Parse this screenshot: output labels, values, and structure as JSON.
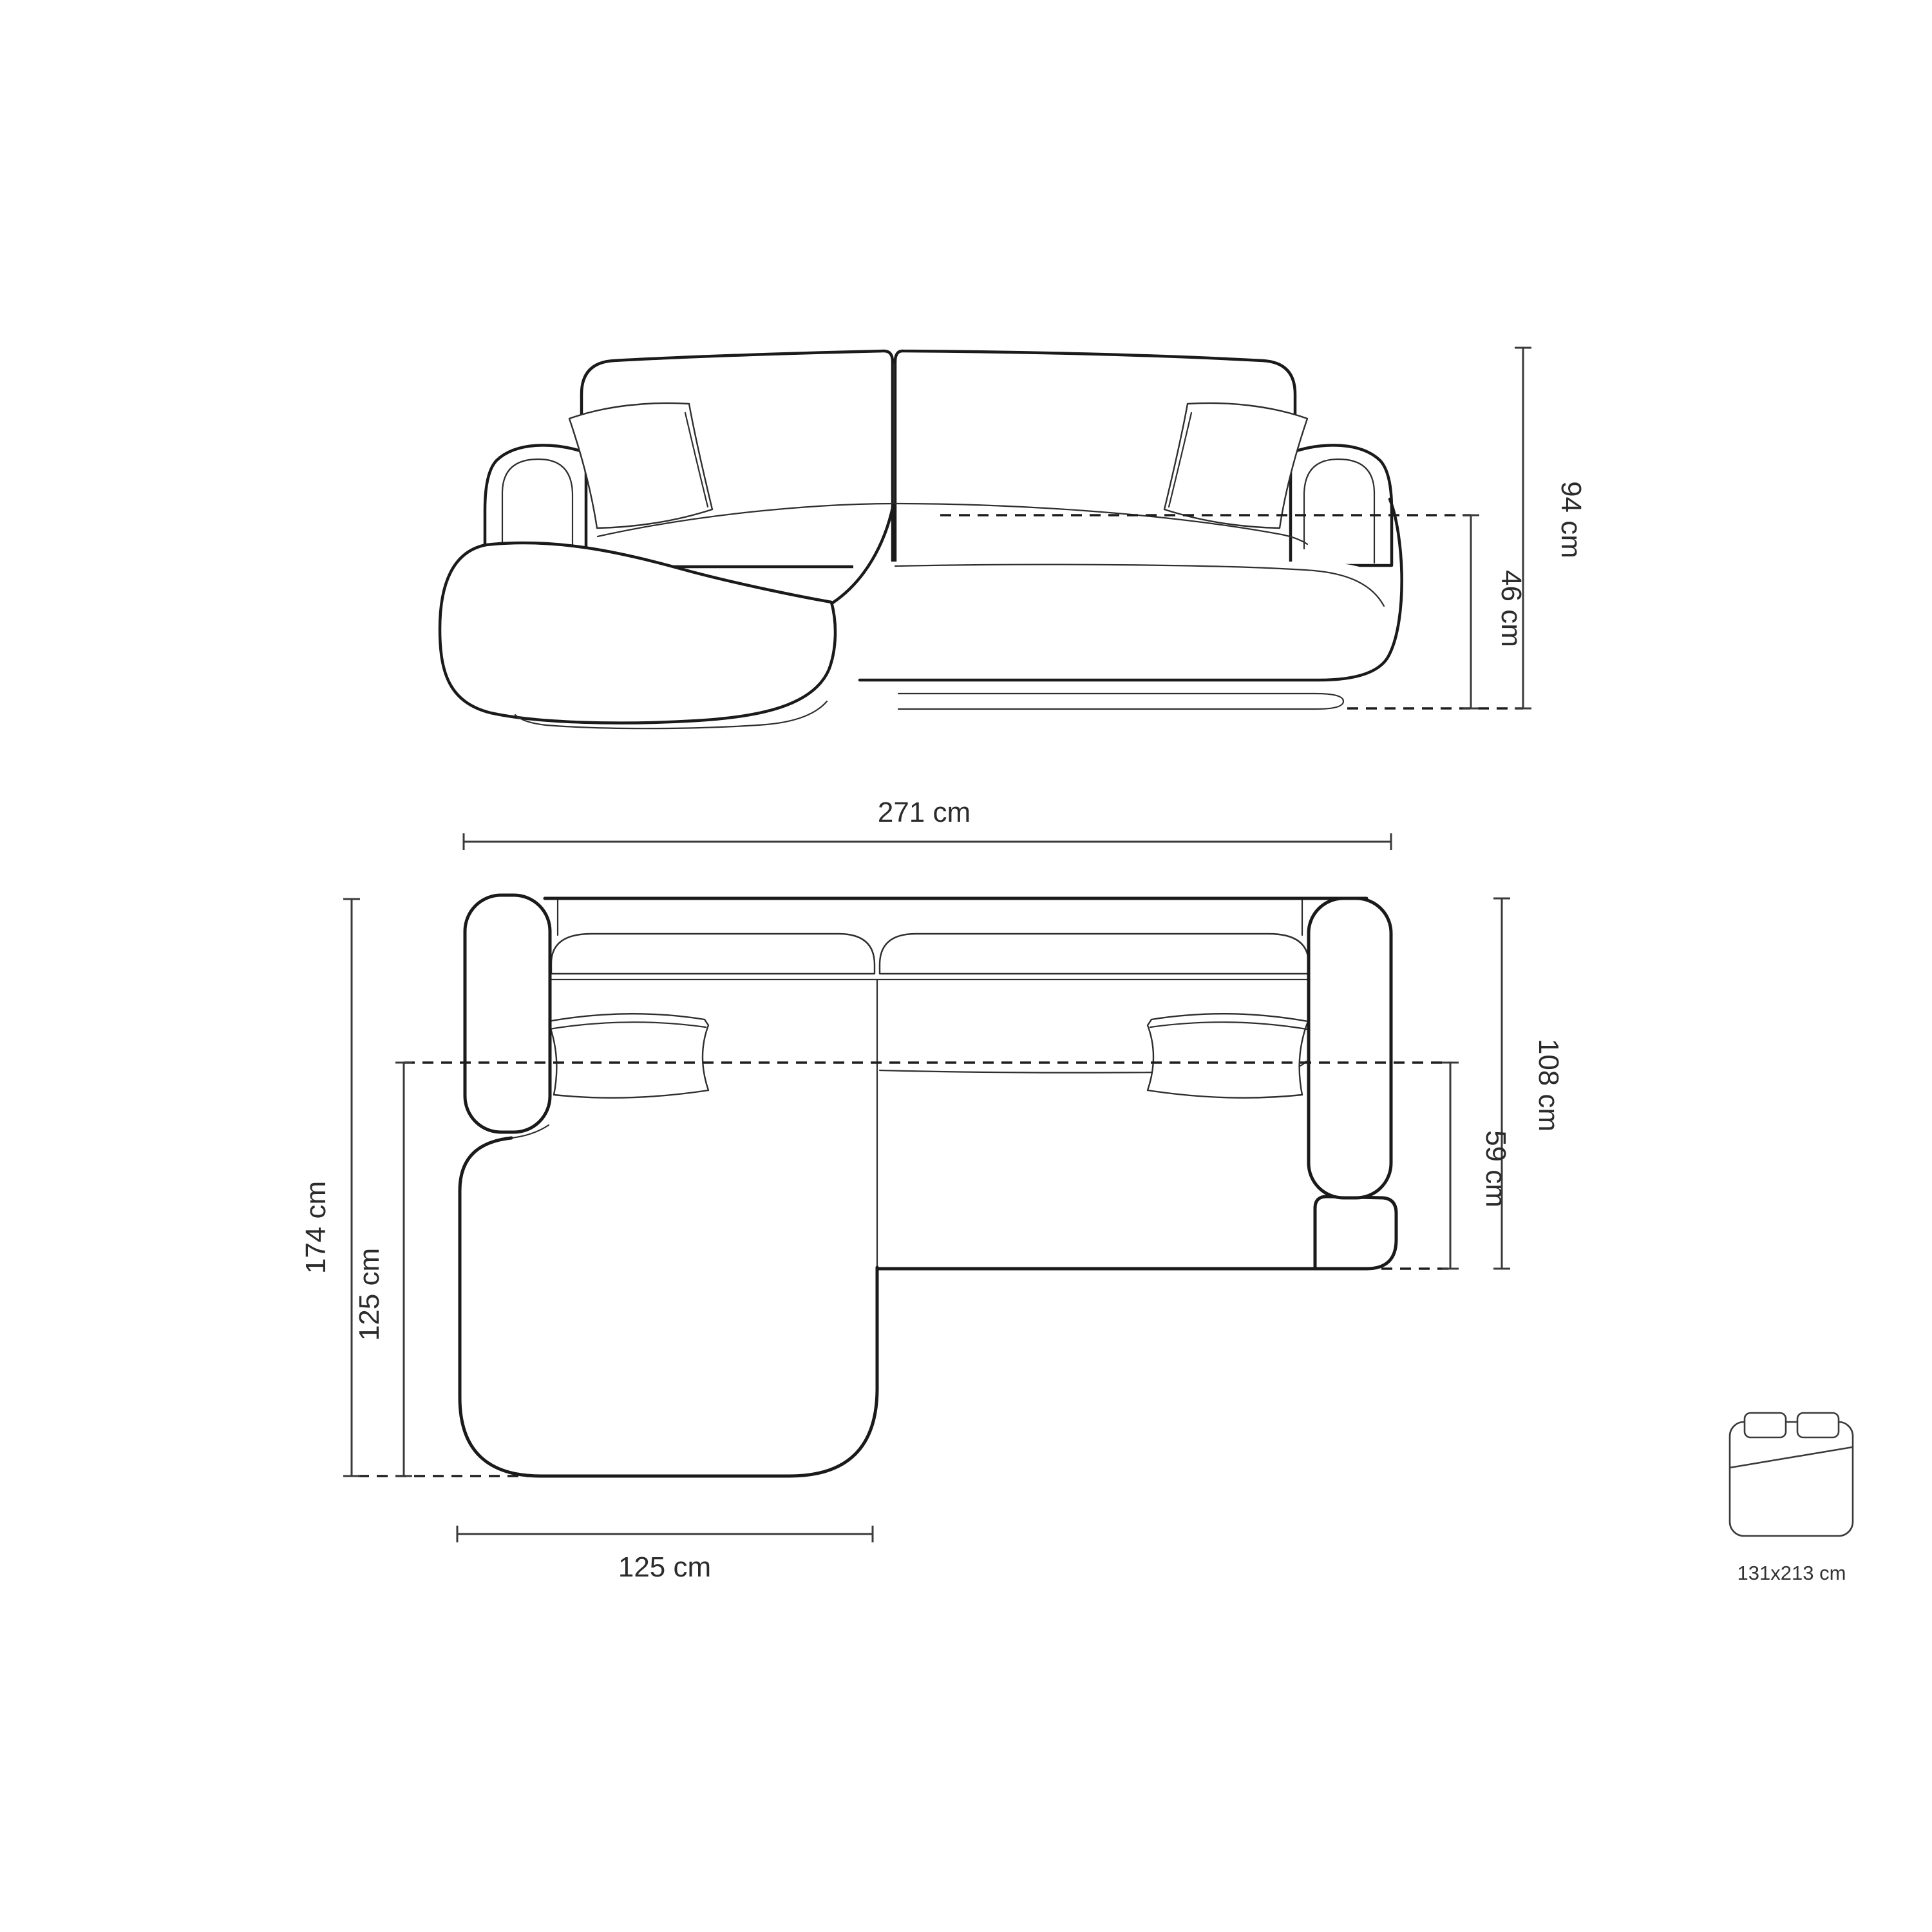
{
  "diagram": {
    "title": "corner-sofa-dimension-drawing",
    "front_view": {
      "labels": {
        "total_height": "94 cm",
        "seat_height": "46 cm"
      }
    },
    "top_view": {
      "labels": {
        "total_width": "271 cm",
        "total_depth": "174 cm",
        "chaise_length": "125 cm",
        "side_depth": "108 cm",
        "seat_depth": "59 cm",
        "chaise_width": "125 cm"
      }
    },
    "sleeping_area": {
      "label": "131x213 cm"
    },
    "colors": {
      "background": "#ffffff",
      "outline": "#1a1a1a",
      "detail_line": "#2e2e2e",
      "dimension_line": "#3a3a3a",
      "text": "#2b2b2b"
    }
  }
}
